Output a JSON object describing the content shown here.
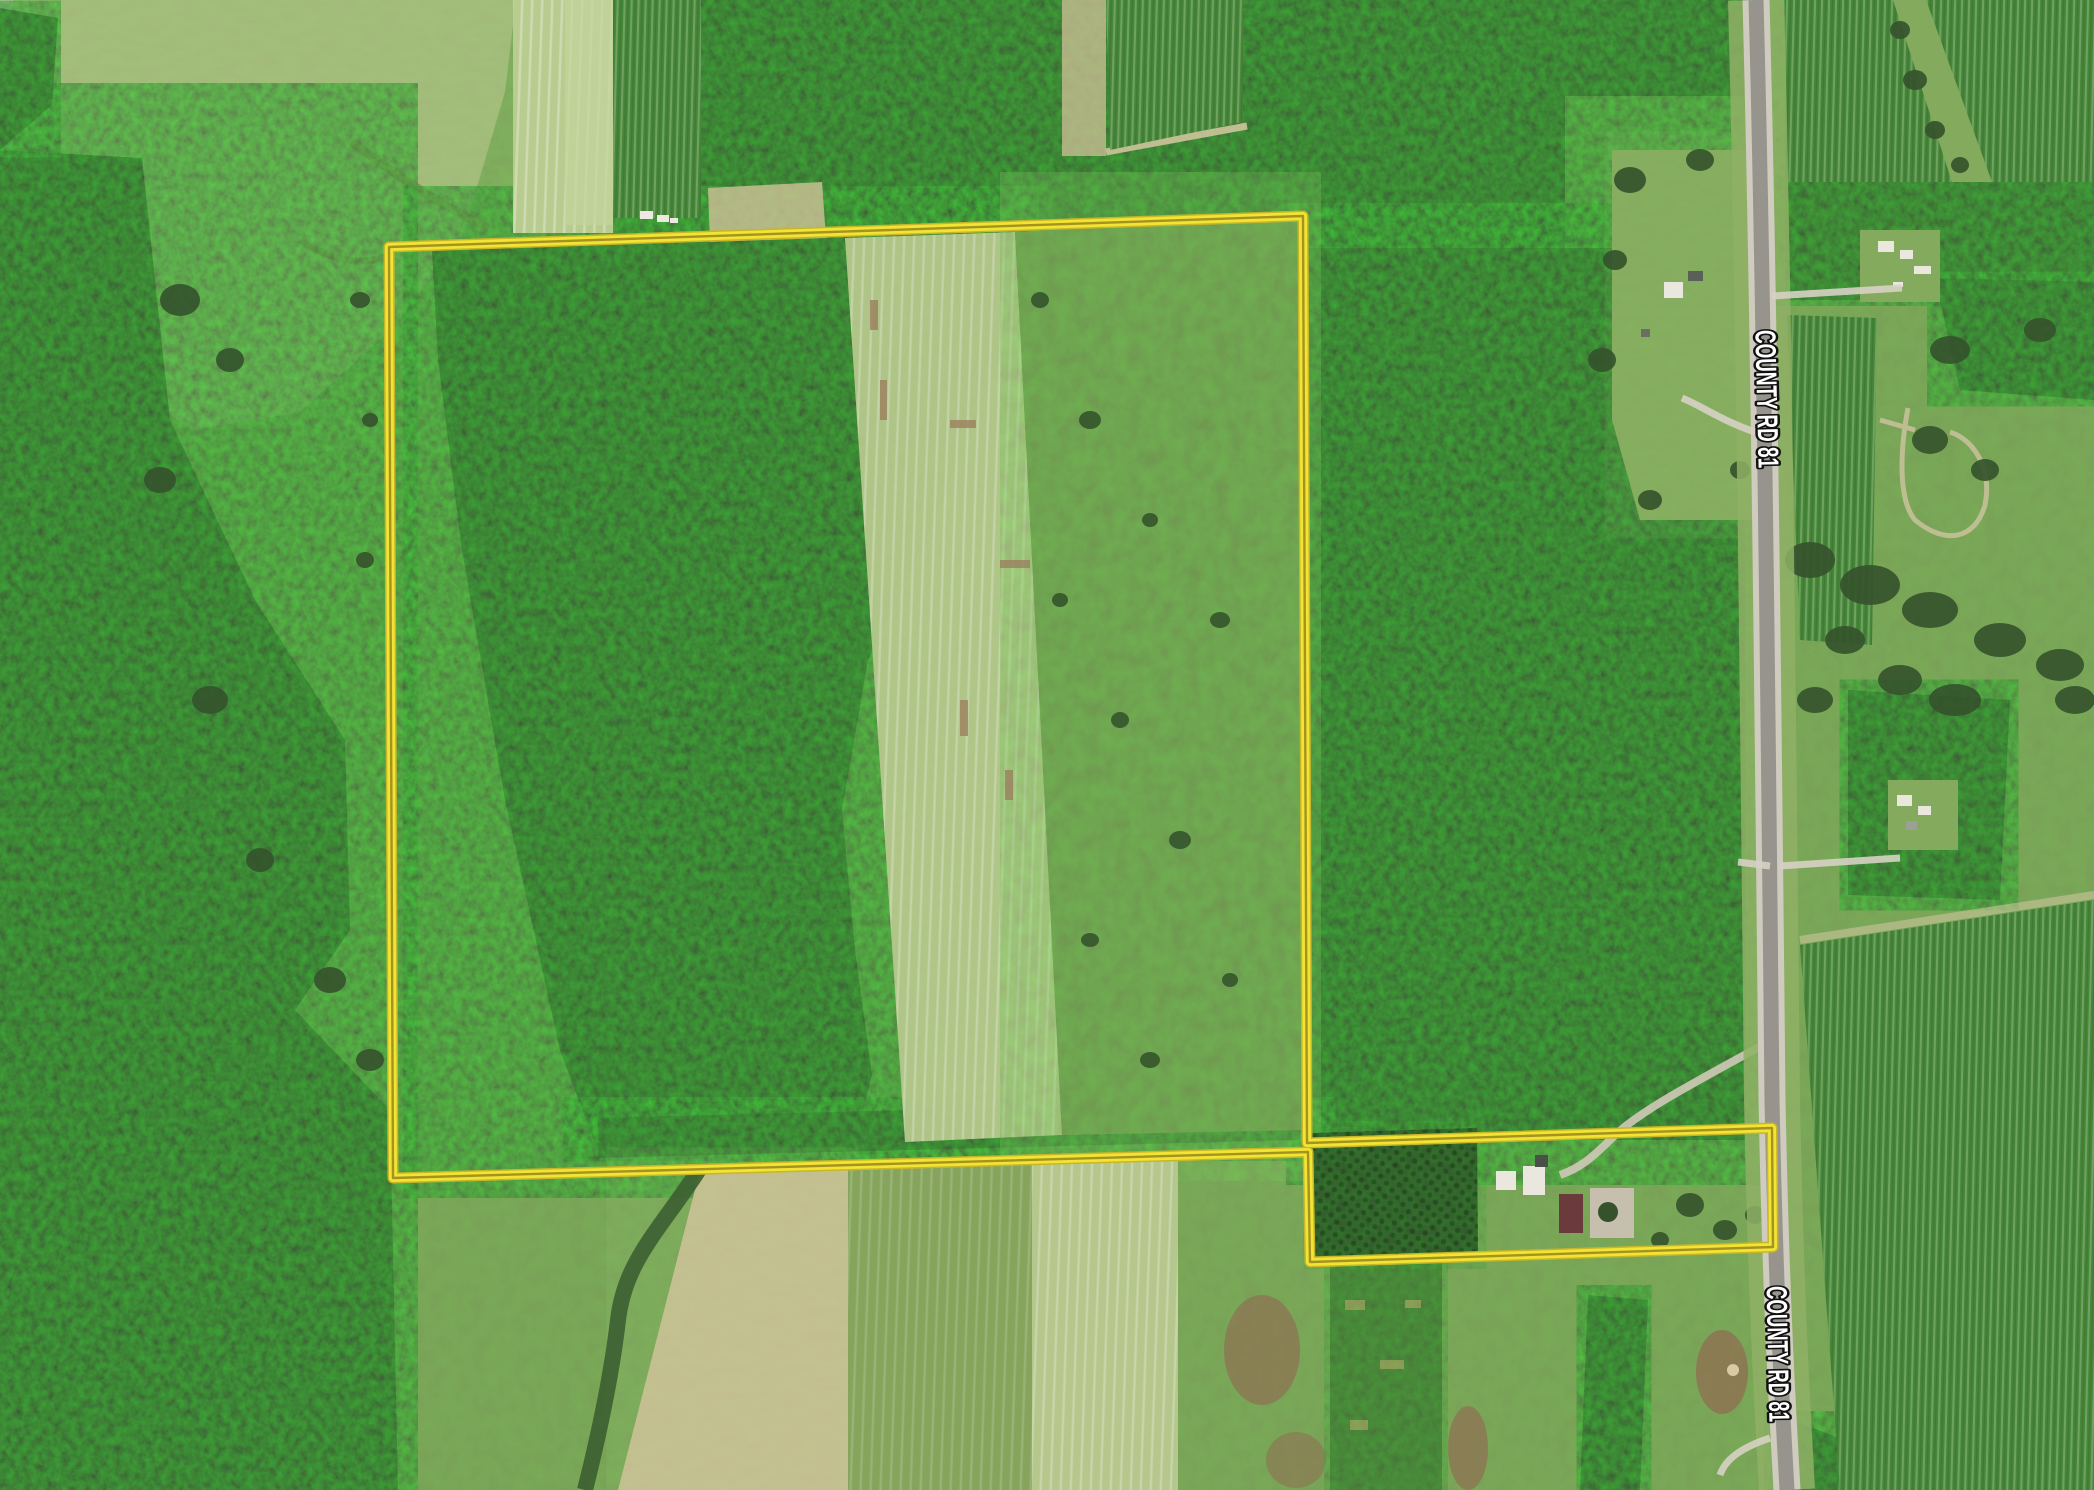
{
  "road": {
    "name": "COUNTY RD 81"
  },
  "labels": [
    {
      "text": "COUNTY RD 81",
      "x": 1766,
      "y": 399,
      "transform": "rotate(88.6 1766 399)",
      "textLength": 138
    },
    {
      "text": "COUNTY RD 81",
      "x": 1777,
      "y": 1354,
      "transform": "rotate(88.8 1777 1354)",
      "textLength": 136
    }
  ],
  "parcel": {
    "points": "389,247 1303,216 1307,1143 1772,1128 1773,1247 1310,1262 1308,1152 393,1178",
    "boundary_color": "#f2e335"
  },
  "colors": {
    "boundary-yellow": "#f2e335",
    "boundary-core": "#a3931f",
    "boundary-outer": "#c8b629",
    "label-fill": "#ffffff",
    "label-stroke": "#111111",
    "pasture": "#7aa257",
    "pasture2": "#84aa5d",
    "forest": "#35522c",
    "brush": "#6c984b",
    "meadow": "#a3b87a",
    "fieldpale": "#b5c78c",
    "crop": "#47873a",
    "fieldtan": "#c7bd92",
    "paved": "#96948d",
    "shoulder": "#cfcbbe",
    "verge": "#8fb065",
    "dirt": "#8f7153",
    "building-white": "#e9e7de",
    "building-red": "#6b3a3c",
    "gravel": "#c6bfae"
  }
}
